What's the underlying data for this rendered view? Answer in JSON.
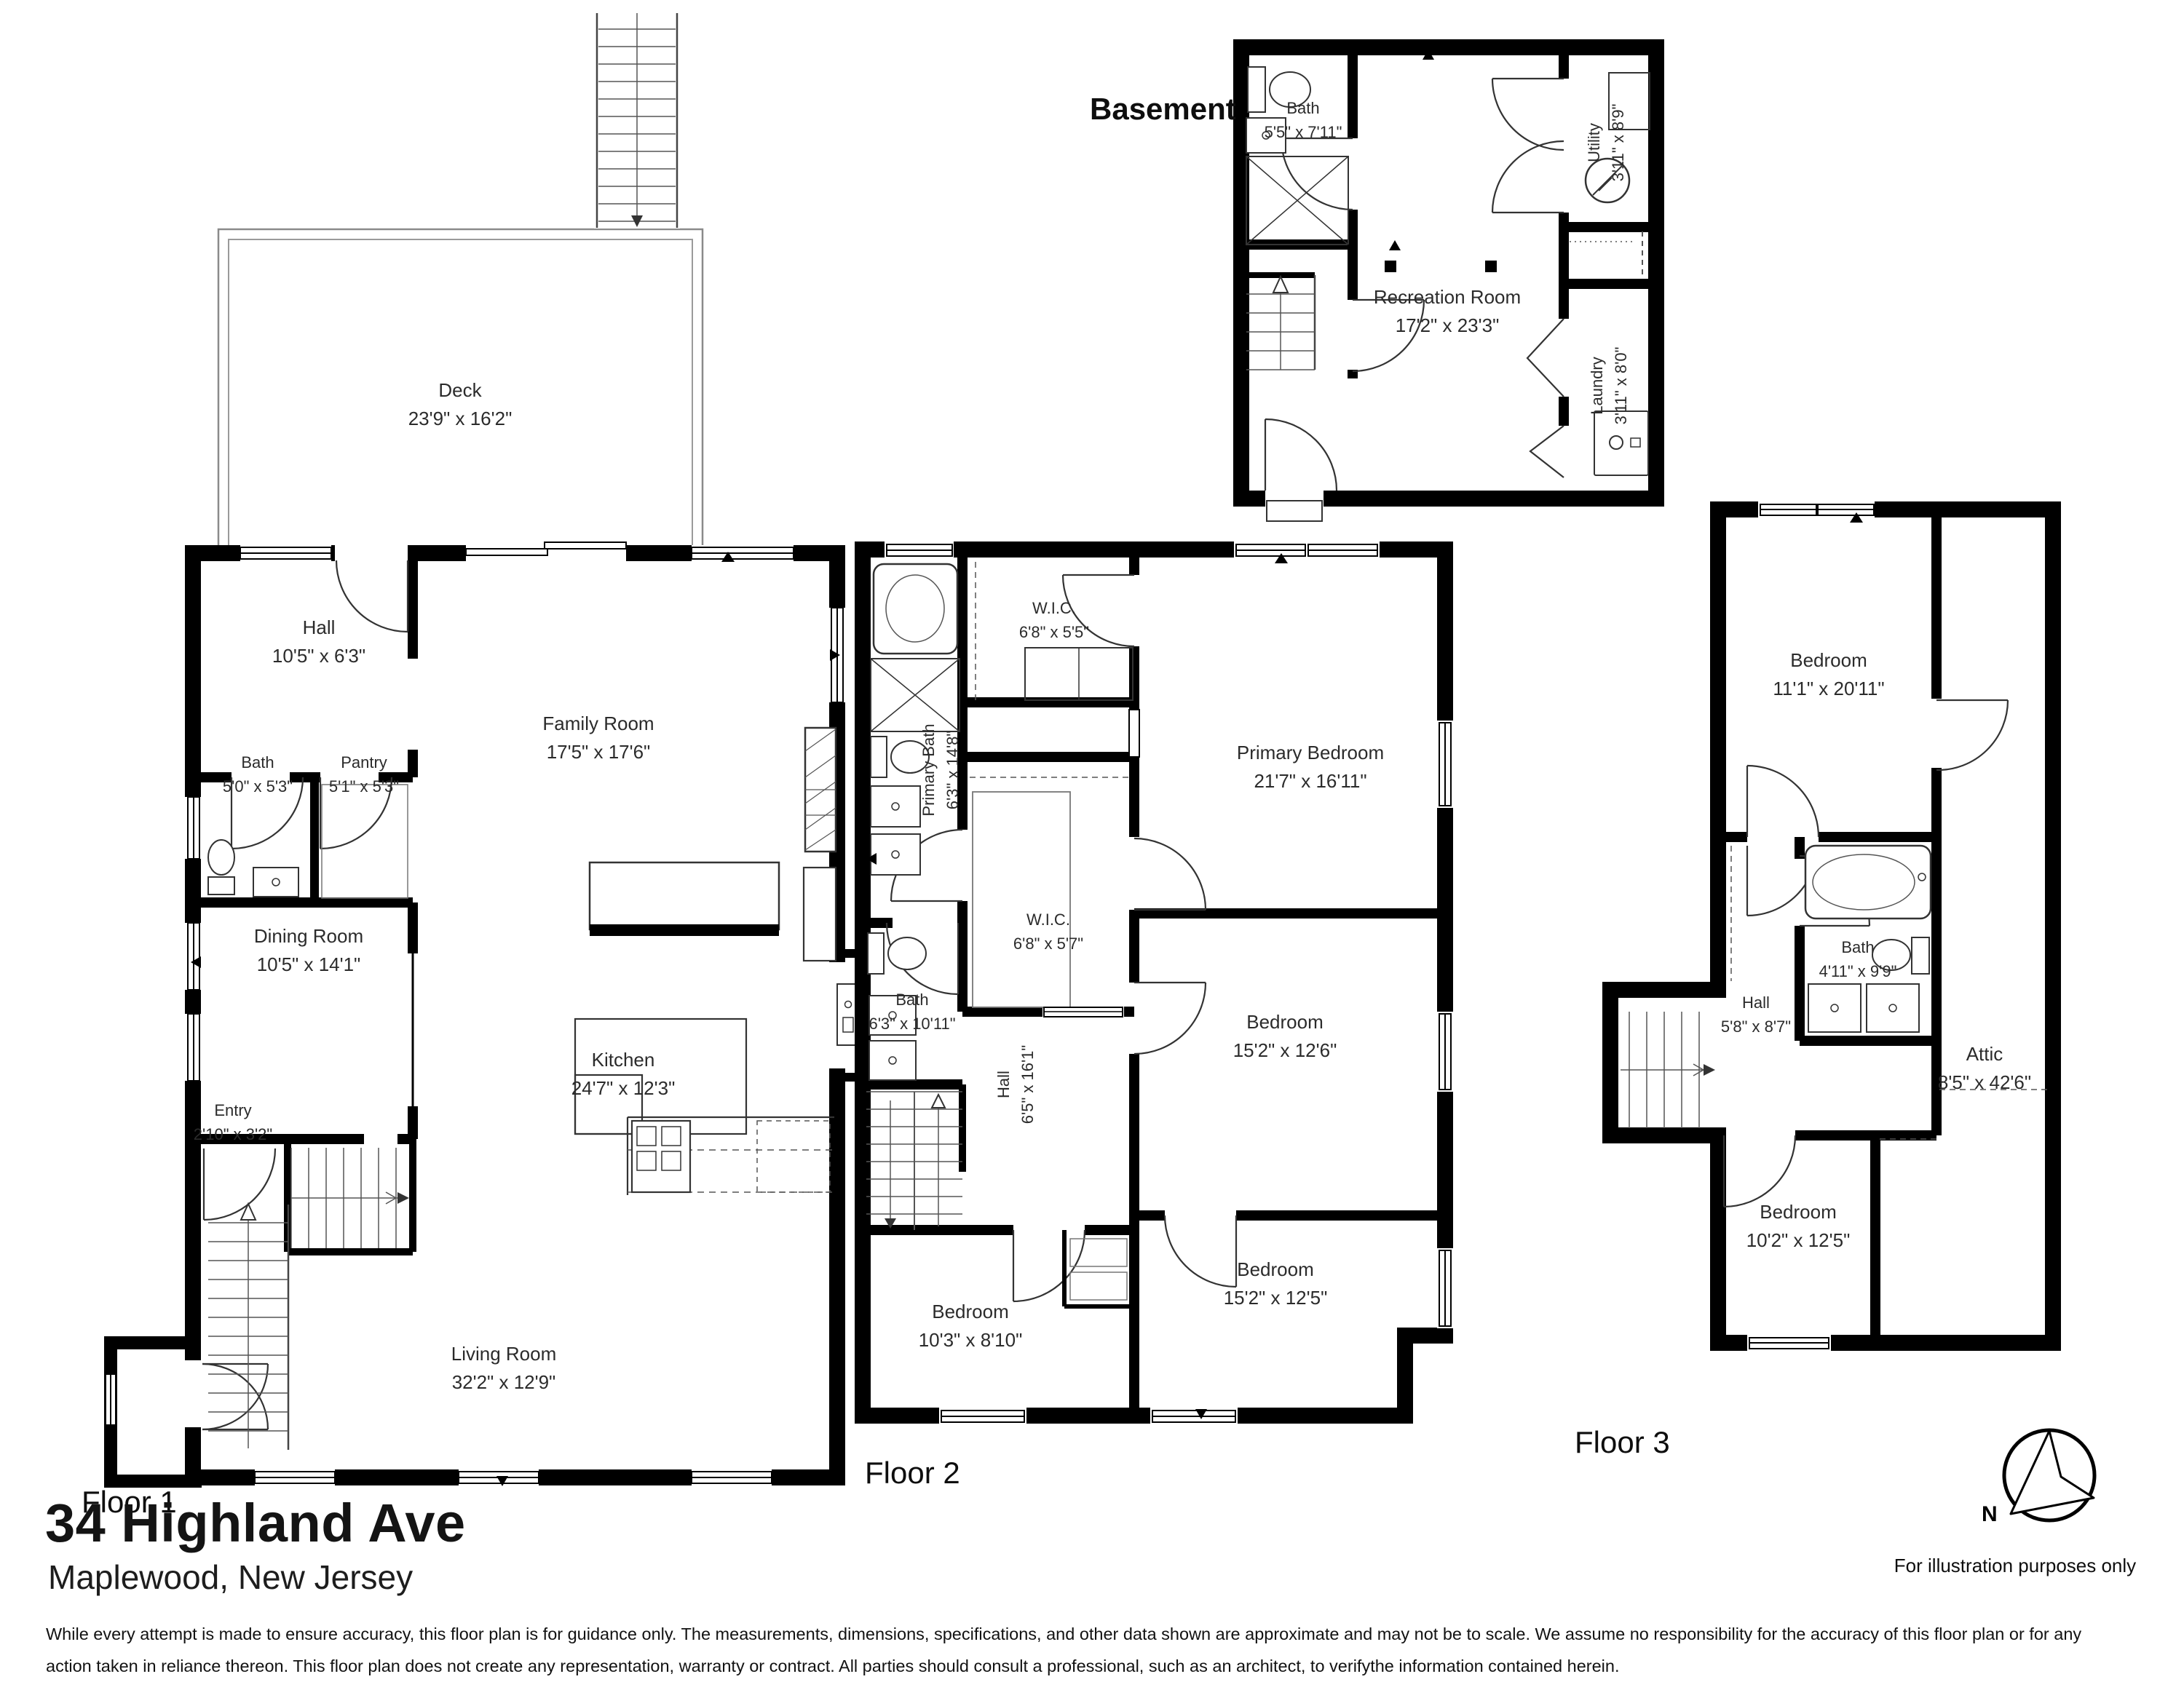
{
  "page": {
    "address": "34 Highland Ave",
    "location": "Maplewood, New Jersey",
    "illustration_note": "For illustration purposes only",
    "compass": "N",
    "disclaimer_line1": "While every attempt is made to ensure accuracy, this floor plan is for guidance only. The measurements, dimensions, specifications, and other data shown are approximate and may not be to scale.  We assume no responsibility for the accuracy of this floor plan or for any",
    "disclaimer_line2": "action taken in reliance thereon. This floor plan does not create any representation, warranty or contract. All parties should consult a professional, such as an architect, to verifythe information contained herein."
  },
  "colors": {
    "walls": "#000000",
    "background": "#ffffff",
    "fixtures": "#3a3a3a"
  },
  "floors": {
    "basement": {
      "label": "Basement",
      "rooms": [
        {
          "name": "Bath",
          "dims": "5'5\" x 7'11\""
        },
        {
          "name": "Utility",
          "dims": "3'11\" x 8'9\""
        },
        {
          "name": "Recreation Room",
          "dims": "17'2\" x 23'3\""
        },
        {
          "name": "Laundry",
          "dims": "3'11\" x 8'0\""
        }
      ]
    },
    "floor1": {
      "label": "Floor 1",
      "rooms": [
        {
          "name": "Deck",
          "dims": "23'9\" x 16'2\""
        },
        {
          "name": "Hall",
          "dims": "10'5\" x 6'3\""
        },
        {
          "name": "Bath",
          "dims": "5'0\" x 5'3\""
        },
        {
          "name": "Pantry",
          "dims": "5'1\" x 5'3\""
        },
        {
          "name": "Family Room",
          "dims": "17'5\" x 17'6\""
        },
        {
          "name": "Dining Room",
          "dims": "10'5\" x 14'1\""
        },
        {
          "name": "Kitchen",
          "dims": "24'7\" x 12'3\""
        },
        {
          "name": "Entry",
          "dims": "2'10\" x 3'2\""
        },
        {
          "name": "Living Room",
          "dims": "32'2\" x 12'9\""
        }
      ]
    },
    "floor2": {
      "label": "Floor 2",
      "rooms": [
        {
          "name": "W.I.C.",
          "dims": "6'8\" x 5'5\""
        },
        {
          "name": "Primary Bath",
          "dims": "6'3\" x 14'8\""
        },
        {
          "name": "W.I.C.",
          "dims": "6'8\" x 5'7\""
        },
        {
          "name": "Primary Bedroom",
          "dims": "21'7\" x 16'11\""
        },
        {
          "name": "Bath",
          "dims": "6'3\" x 10'11\""
        },
        {
          "name": "Hall",
          "dims": "6'5\" x 16'1\""
        },
        {
          "name": "Bedroom",
          "dims": "15'2\" x 12'6\""
        },
        {
          "name": "Bedroom",
          "dims": "10'3\" x 8'10\""
        },
        {
          "name": "Bedroom",
          "dims": "15'2\" x 12'5\""
        }
      ]
    },
    "floor3": {
      "label": "Floor 3",
      "rooms": [
        {
          "name": "Bedroom",
          "dims": "11'1\" x 20'11\""
        },
        {
          "name": "Bath",
          "dims": "4'11\" x 9'9\""
        },
        {
          "name": "Hall",
          "dims": "5'8\" x 8'7\""
        },
        {
          "name": "Attic",
          "dims": "8'5\" x 42'6\""
        },
        {
          "name": "Bedroom",
          "dims": "10'2\" x 12'5\""
        }
      ]
    }
  }
}
